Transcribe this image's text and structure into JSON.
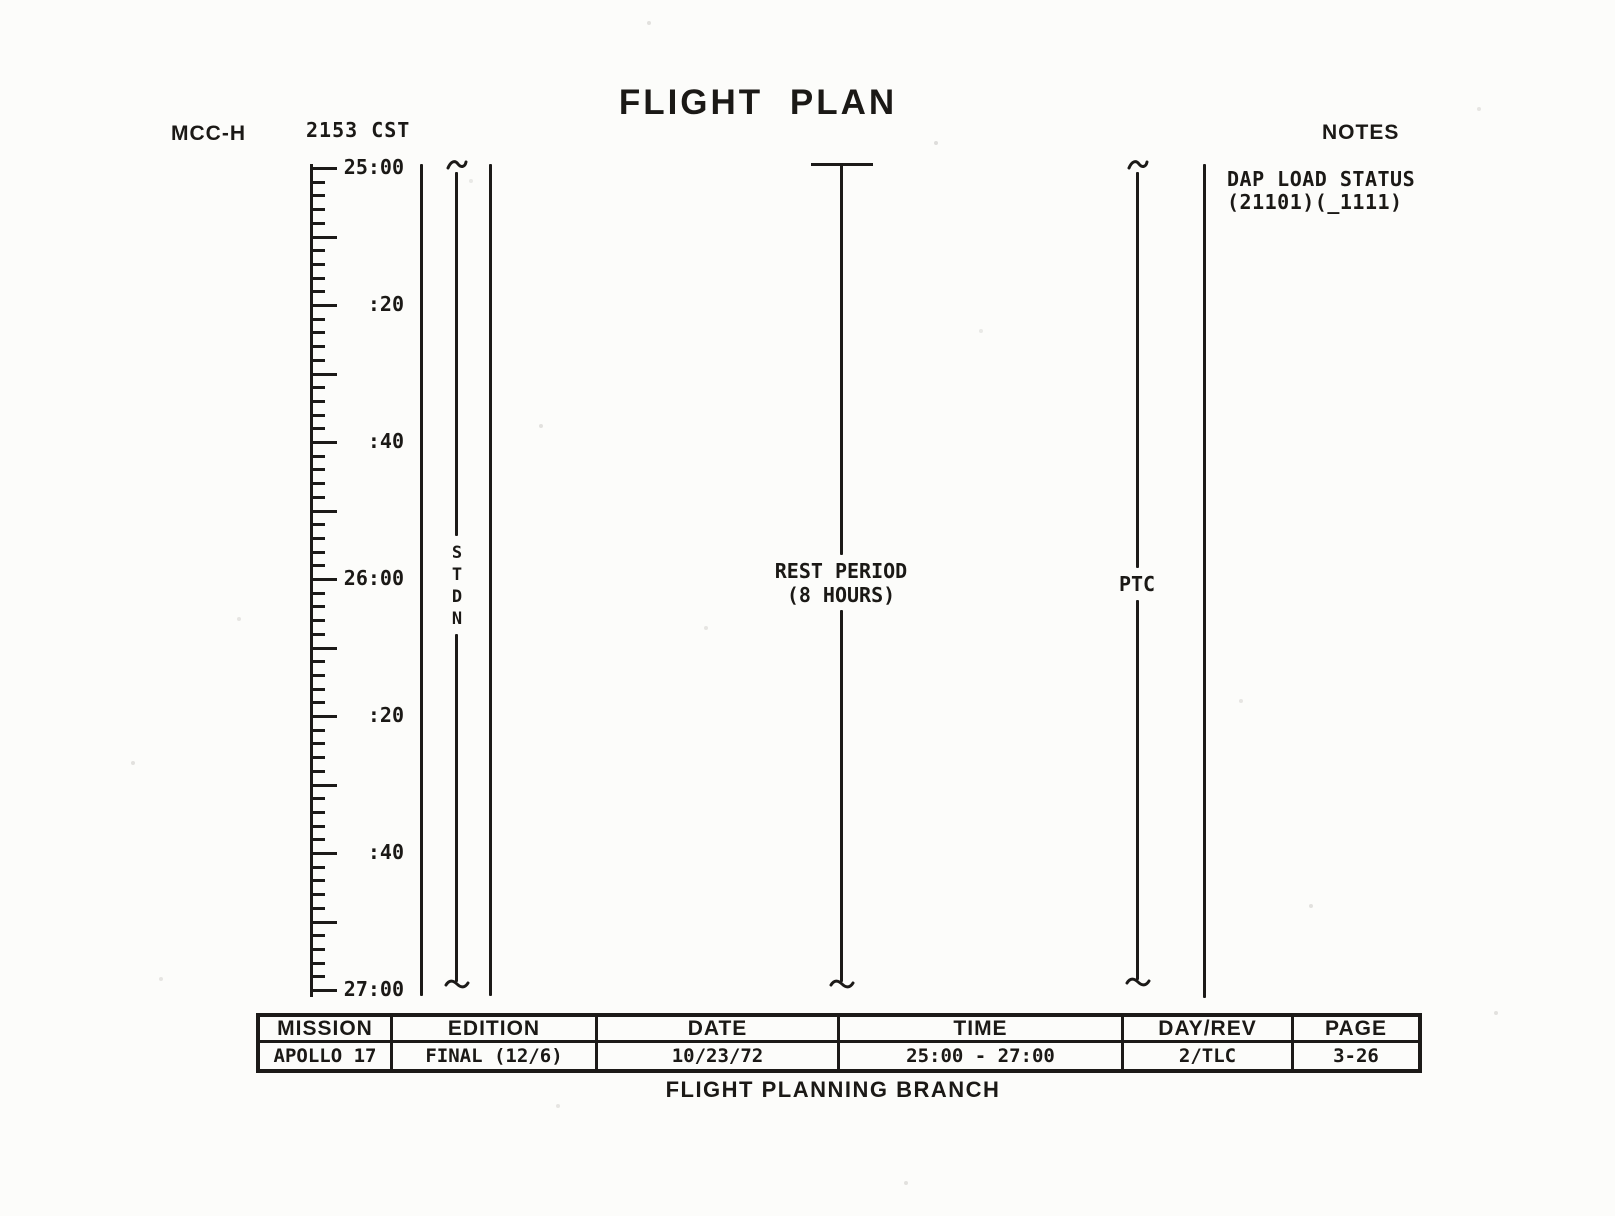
{
  "header": {
    "station": "MCC-H",
    "clock": "2153 CST",
    "title": "FLIGHT PLAN",
    "notes_heading": "NOTES"
  },
  "notes": {
    "dap_line1": "DAP LOAD STATUS",
    "dap_line2": "(21101)(_1111)"
  },
  "timeline": {
    "start": "25:00",
    "end": "27:00",
    "duration_min": 120,
    "minor_tick_min": 2,
    "major_tick_min": 10,
    "tick_labels": [
      {
        "text": "25:00",
        "min": 0
      },
      {
        "text": ":20",
        "min": 20
      },
      {
        "text": ":40",
        "min": 40
      },
      {
        "text": "26:00",
        "min": 60
      },
      {
        "text": ":20",
        "min": 80
      },
      {
        "text": ":40",
        "min": 100
      },
      {
        "text": "27:00",
        "min": 120
      }
    ]
  },
  "activities": {
    "stdn_label": "S\nT\nD\nN",
    "rest_line1": "REST PERIOD",
    "rest_line2": "(8 HOURS)",
    "ptc_label": "PTC"
  },
  "table": {
    "columns": [
      {
        "header": "MISSION",
        "value": "APOLLO 17"
      },
      {
        "header": "EDITION",
        "value": "FINAL (12/6)"
      },
      {
        "header": "DATE",
        "value": "10/23/72"
      },
      {
        "header": "TIME",
        "value": "25:00 - 27:00"
      },
      {
        "header": "DAY/REV",
        "value": "2/TLC"
      },
      {
        "header": "PAGE",
        "value": "3-26"
      }
    ],
    "footer": "FLIGHT PLANNING BRANCH"
  },
  "colors": {
    "ink": "#1c1a18",
    "paper": "#fcfcfa"
  }
}
